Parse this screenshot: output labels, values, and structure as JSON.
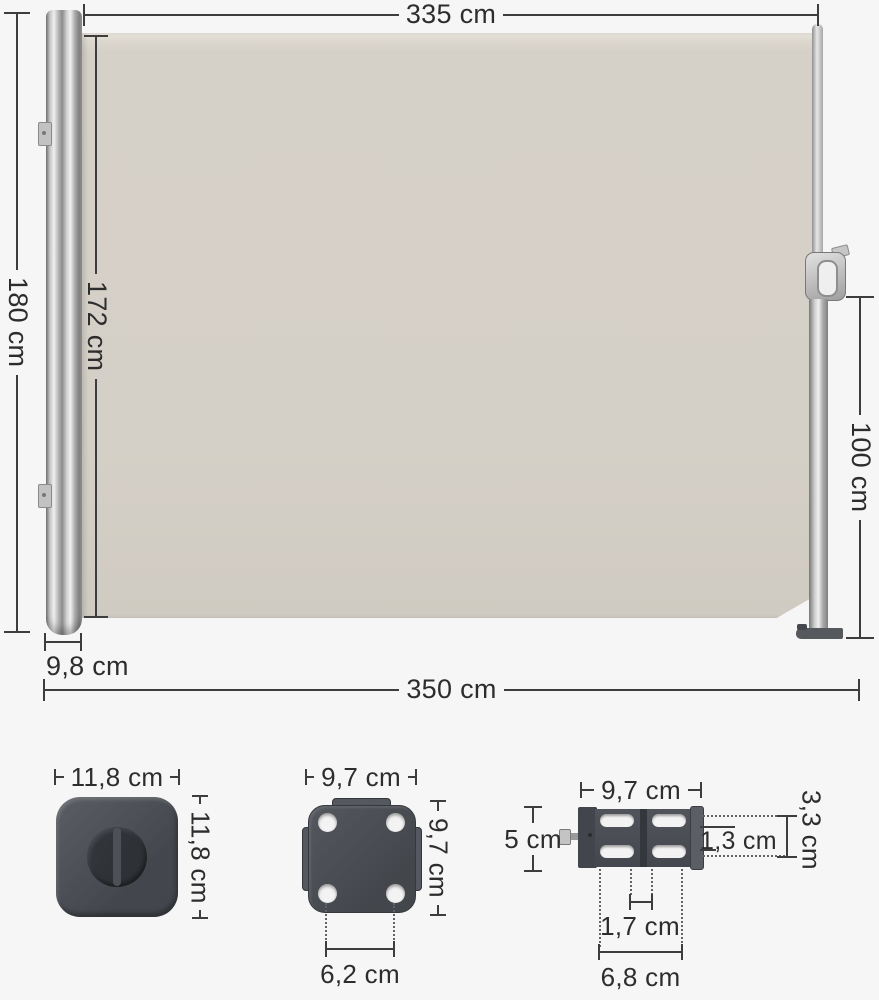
{
  "diagram_title": "side-awning-dimension-diagram",
  "colors": {
    "background": "#f6f6f6",
    "fabric": "#d6d1c8",
    "hardware": "#4a4e54",
    "line": "#3d3d3d",
    "text": "#2d2d2d"
  },
  "main_diagram": {
    "fabric_width": "335 cm",
    "total_height": "180 cm",
    "fabric_height": "172 cm",
    "front_pole_height": "100 cm",
    "cassette_depth": "9,8 cm",
    "total_width": "350 cm"
  },
  "parts": {
    "end_cap": {
      "width": "11,8 cm",
      "height": "11,8 cm"
    },
    "wall_plate": {
      "width": "9,7 cm",
      "height": "9,7 cm",
      "hole_spacing": "6,2 cm"
    },
    "wall_bracket": {
      "width": "9,7 cm",
      "height": "5 cm",
      "slot_column_height": "3,3 cm",
      "slot_height": "1,3 cm",
      "slot_gap": "1,7 cm",
      "slot_span": "6,8 cm"
    }
  }
}
